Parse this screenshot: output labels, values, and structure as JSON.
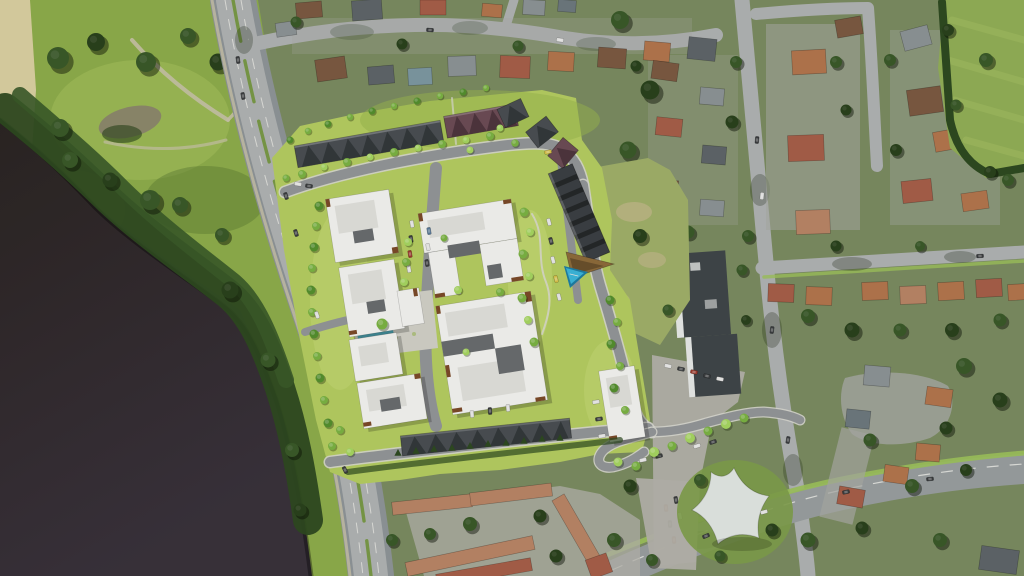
{
  "scene": {
    "type": "aerial-site-plan-rendering",
    "regions": [
      "river",
      "waterfront-park-with-paths",
      "beach-strip",
      "main-boulevard",
      "proposed-development-site-plan",
      "suburban-neighborhood",
      "school-building-with-parking",
      "existing-townhouse-complex",
      "white-canopy-pavilion",
      "sports-field",
      "bottom-arterial-road"
    ],
    "site_plan": {
      "white_midrise_buildings": 7,
      "townhouse_rows_dark_roof": 2,
      "townhouse_rows_maroon_roof": 1,
      "long_east_building": 1,
      "features": [
        "internal-road-loop",
        "central-parking-with-cars",
        "pedestrian-plaza",
        "reflecting-water-feature",
        "triangular-pool",
        "brown-deck",
        "landscape-trees",
        "conifer-hedge-row",
        "curved-access-road"
      ]
    }
  },
  "colors": {
    "suburb_base": "#7c8d63",
    "park_grass": "#8fae4c",
    "park_grass_light": "#a5c25e",
    "park_shadow": "#5f7e35",
    "sand": "#ddd2a4",
    "dirt": "#8d8570",
    "lawn": "#7fa04b",
    "driveway": "#a9aba6",
    "tree_photo": "#3a5a2a",
    "tree_photo_dark": "#2a421d",
    "field": "#93b058",
    "field_meadow": "#a2b26b",
    "meadow_patch": "#c2b98a",
    "water_top": "#2b2423",
    "water_bottom": "#39323c",
    "photo_road": "#b2b5b6",
    "photo_road_dark": "#90969a",
    "road_line": "#e9e9e5",
    "arterial": "#9aa0a2",
    "verge": "#9fc45c",
    "median_green": "#7a9a48",
    "path": "#cac4ab",
    "plan_path": "#dcdcd2",
    "roof_orange": "#b5764f",
    "roof_red": "#a85f4a",
    "roof_brown": "#7d5a43",
    "roof_gray": "#8e9598",
    "roof_dark": "#5f666b",
    "roof_slate": "#6e7a80",
    "roof_blue": "#7e99a4",
    "roof_salmon": "#bb8668",
    "roof_tan": "#c09a72",
    "school_roof": "#40464a",
    "school_white": "#e9ebea",
    "parking_lot": "#b6b4ad",
    "canopy_white": "#e4e9e6",
    "plan_grass": "#b7cf63",
    "plan_grass_light": "#c8dc78",
    "plan_grass_dark": "#9ab84e",
    "plan_road": "#94979a",
    "curb": "#d9d9d3",
    "plaza": "#d3d2ca",
    "bldg_white": "#f6f6f4",
    "bldg_shade": "#e3e3df",
    "bldg_notch": "#6a6d70",
    "bldg_accent": "#7c4a2a",
    "town_roof": "#4a4f54",
    "town_roof_dark": "#33383c",
    "maroon_roof": "#6d4c57",
    "maroon_dark": "#4e353f",
    "east_roof": "#3c4045",
    "east_ridge": "#24272a",
    "deck_brown": "#8f6c3c",
    "pool": "#3cb8de",
    "pool_dark": "#1d7fa6",
    "water_feature": "#4fa8b8",
    "hedge": "#2e4a21",
    "plan_tree": "#7cb544",
    "plan_tree_light": "#a8d862",
    "plan_tree_dark": "#55912f",
    "car_white": "#e8e8e8",
    "car_dark": "#3a3d40",
    "car_red": "#9c3a2e",
    "car_blue": "#5a7a9a",
    "car_yellow": "#d8c24a"
  }
}
